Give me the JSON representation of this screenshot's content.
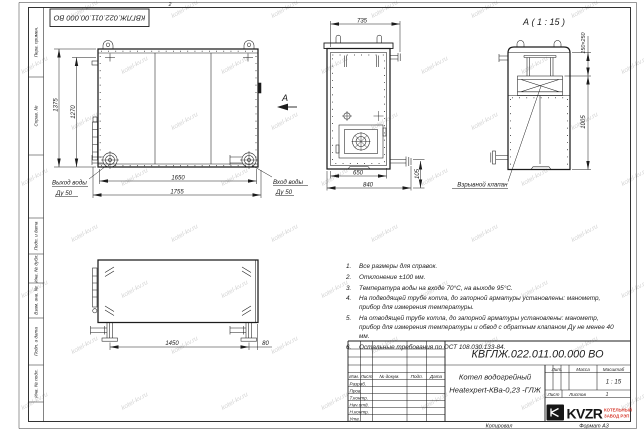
{
  "colors": {
    "line": "#1c1c1c",
    "accent_red": "#d63a2e",
    "watermark": "#6e6e6e"
  },
  "watermark_text": "kotel-kv.ru",
  "frame": {
    "zone_number": "2"
  },
  "doc_box_number": "КВГЛЖ.022.011.00.000 ВО",
  "stamp_column": {
    "cells": [
      "Перв. примен.",
      "Справ. №",
      "Подп. и дата",
      "Инв. № дубл.",
      "Взам. инв. №",
      "Подп. и дата",
      "Инв. № подл."
    ]
  },
  "front_view": {
    "dim_height_overall": "1375",
    "dim_height": "1270",
    "dim_width": "1650",
    "dim_width_overall": "1755",
    "label_outlet": "Выход воды",
    "label_outlet_dn": "Ду 50",
    "label_inlet": "Вход воды",
    "label_inlet_dn": "Ду 50",
    "view_arrow_label": "А"
  },
  "top_view": {
    "dim_width": "735",
    "dim_base": "650",
    "dim_overall": "840",
    "dim_pipe_offset": "105"
  },
  "detail_a": {
    "title": "А ( 1 : 15 )",
    "dim_valve": "150×250",
    "dim_height": "1005",
    "callout": "Взрывной клапан"
  },
  "bottom_view": {
    "dim_length": "1450",
    "dim_offset": "80"
  },
  "notes": [
    {
      "n": "1.",
      "text": "Все размеры для справок."
    },
    {
      "n": "2.",
      "text": "Отклонение ±100 мм."
    },
    {
      "n": "3.",
      "text": "Температура воды на входе 70°С, на выходе 95°С."
    },
    {
      "n": "4.",
      "text": "На подводящей трубе котла, до запорной арматуры установлены: манометр, прибор для измерения температуры."
    },
    {
      "n": "5.",
      "text": "На отводящей трубе котла, до запорной арматуры установлены: манометр, прибор для измерения температуры и обвод с обратным клапаном Ду не менее 40 мм."
    },
    {
      "n": "6.",
      "text": "Остальные требования по ОСТ 108.030.133-84."
    }
  ],
  "title_block": {
    "doc_number": "КВГЛЖ.022.011.00.000 ВО",
    "name_line1": "Котел водогрейный",
    "name_line2": "Heatexpert-КВа-0,23 -ГЛЖ",
    "cols": {
      "izm": "Изм.",
      "list": "Лист",
      "doc": "№ докум.",
      "podp": "Подп.",
      "data": "Дата"
    },
    "rows": {
      "razrab": "Разраб.",
      "prov": "Пров.",
      "tkontr": "Т.контр.",
      "nachotd": "Нач.отд.",
      "nkontr": "Н.контр.",
      "utv": "Утв."
    },
    "lit": "Лит.",
    "massa": "Масса",
    "masshtab": "Масштаб",
    "scale_value": "1 : 15",
    "list_label": "Лист",
    "listov_label": "Листов",
    "listov_value": "1",
    "logo_text": "KVZR",
    "company_line1": "КОТЕЛЬНЫЙ",
    "company_line2": "ЗАВОД РЭП"
  },
  "footer": {
    "copied": "Копировал",
    "format": "Формат А3"
  }
}
